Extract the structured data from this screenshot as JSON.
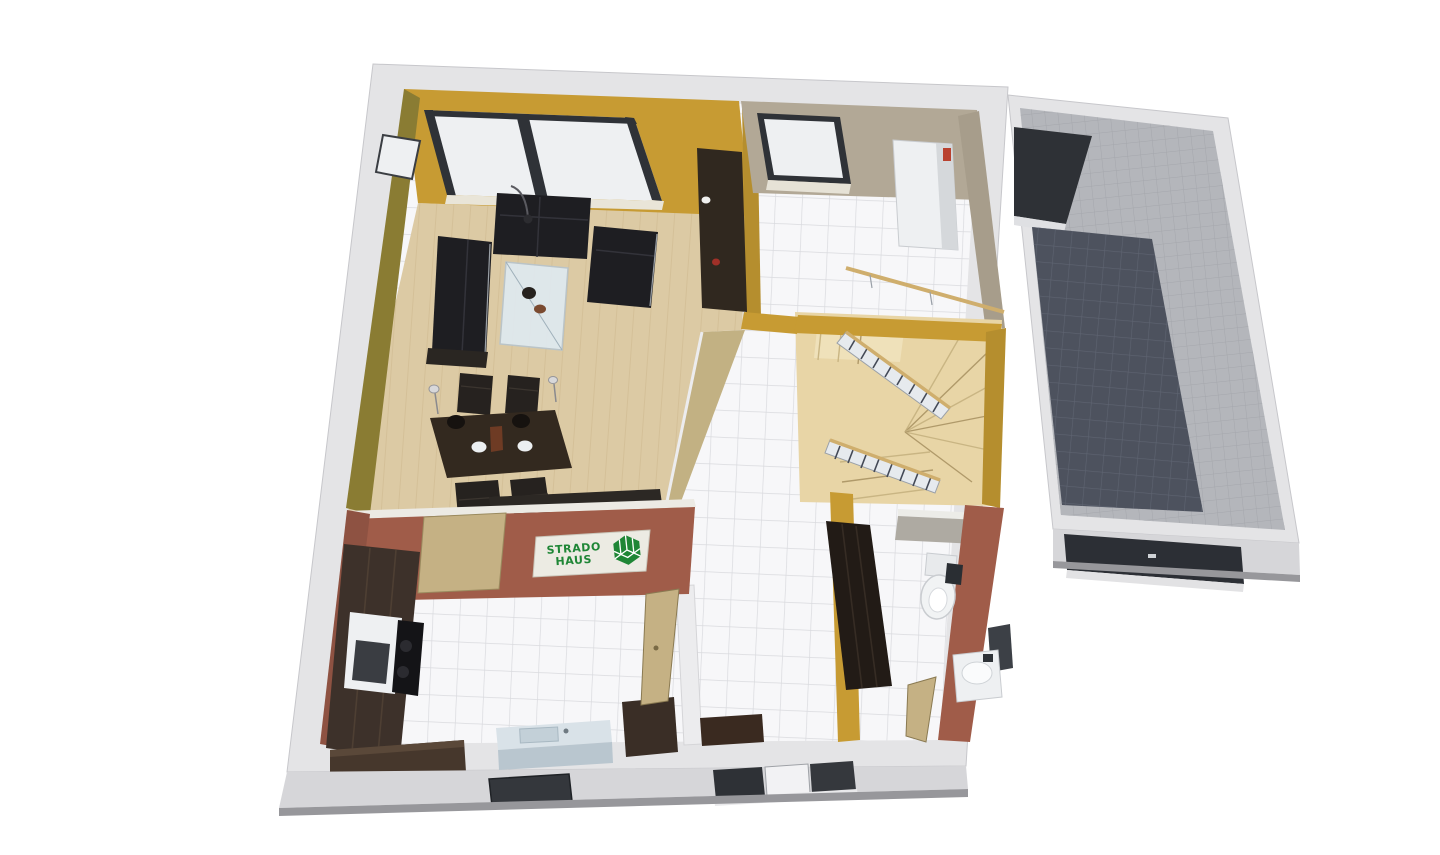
{
  "logo": {
    "line1": "STRADO",
    "line2": "HAUS"
  },
  "colors": {
    "background": "#ffffff",
    "wall_top": "#e4e4e6",
    "wall_front": "#d6d6d9",
    "wall_under": "#97979b",
    "wall_edge": "#c7c7cb",
    "mustard": "#c79b33",
    "mustard_shade": "#8a7c33",
    "mustard_deep": "#b58e2e",
    "taupe": "#b2a896",
    "taupe_shade": "#a79d8b",
    "redbrown": "#a05c49",
    "redbrown_shade": "#8e5242",
    "tan_wall": "#c2b183",
    "wood_floor": "#dccaa4",
    "tile_floor": "#f7f7f9",
    "stair_wood": "#e8d5a6",
    "garage_floor": "#4d525e",
    "garage_wall": "#b4b6bb",
    "dark_furniture": "#1e1e22",
    "brown_furniture": "#33291f",
    "cabinet_wood": "#3d312a",
    "glass": "#dfeaf0",
    "appliance": "#eef0f2",
    "door_dark": "#2e3136",
    "door_khaki": "#c5b184",
    "rail_wood": "#cfae6d",
    "logo_green": "#1f8636",
    "logo_bg": "#ecebe3"
  },
  "rooms": [
    "living-dining-room",
    "kitchen",
    "hallway",
    "bathroom",
    "utility-room",
    "staircase",
    "garage"
  ]
}
